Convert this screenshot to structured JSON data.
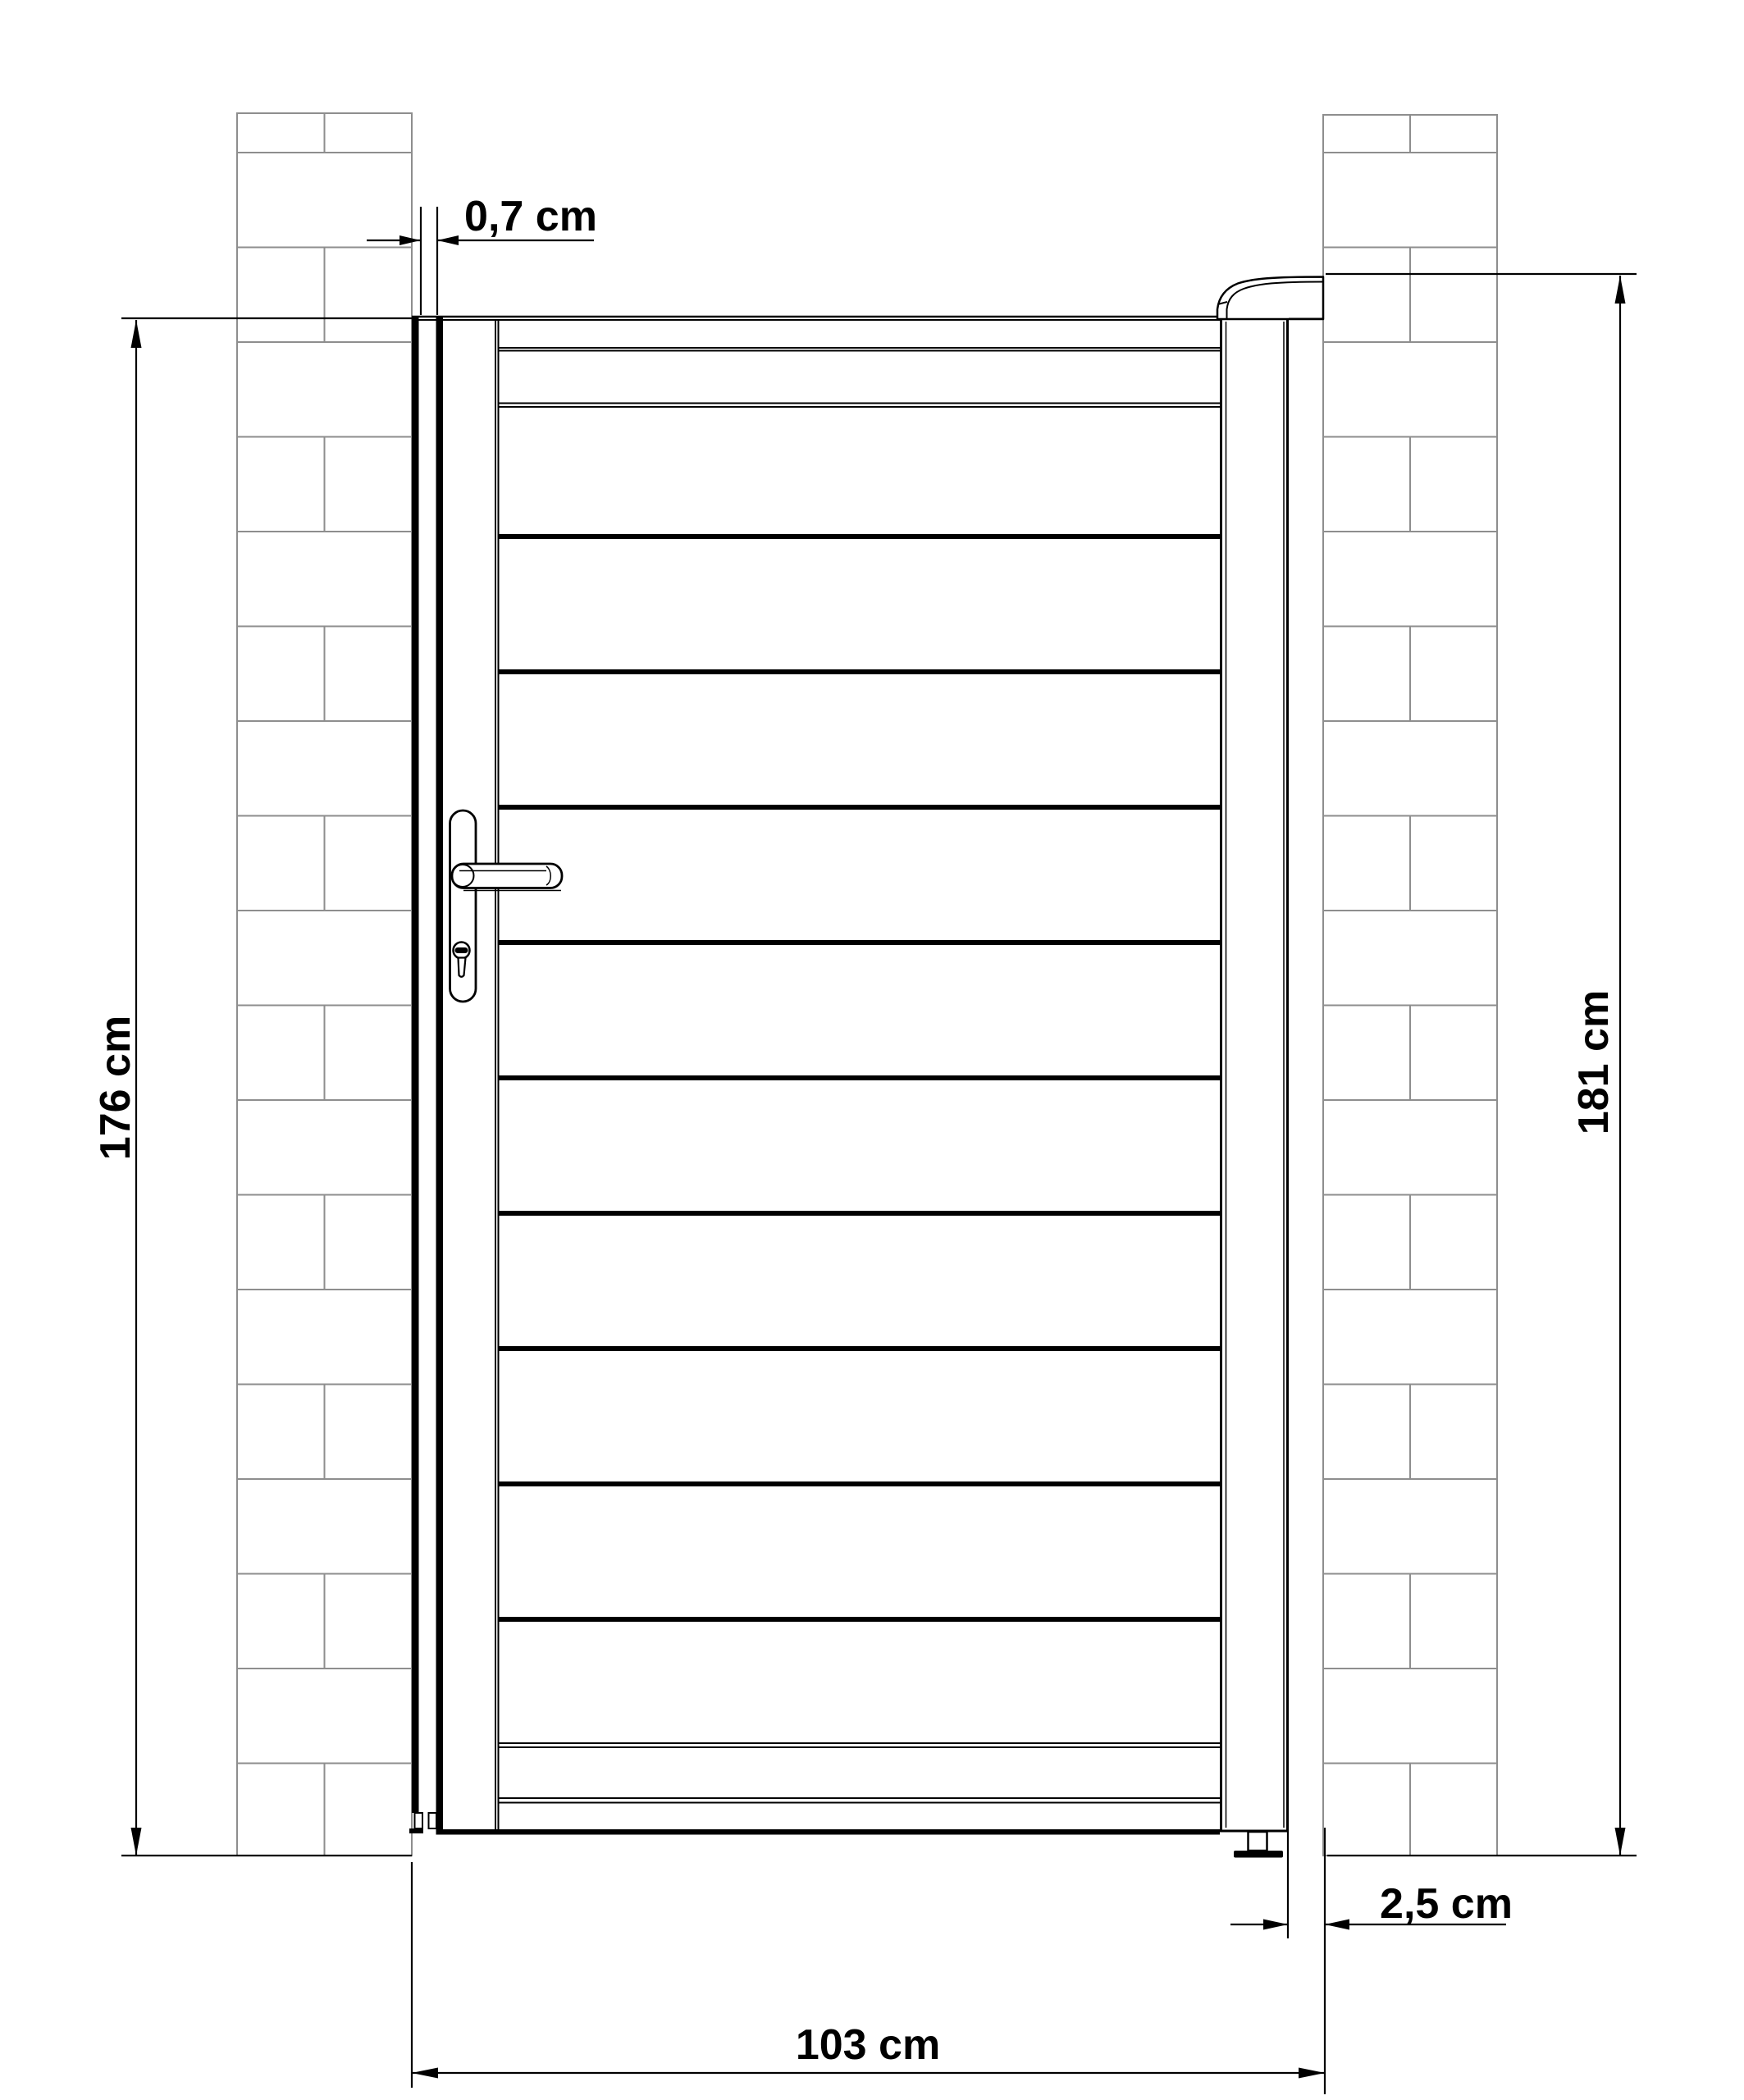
{
  "dimensions": {
    "hinge_gap": {
      "label": "0,7 cm"
    },
    "gate_height": {
      "label": "176 cm"
    },
    "total_height": {
      "label": "181 cm"
    },
    "latch_gap": {
      "label": "2,5 cm"
    },
    "opening_width": {
      "label": "103 cm"
    }
  },
  "colors": {
    "line": "#000000",
    "masonry": "#8e8e8e",
    "background": "#ffffff"
  }
}
